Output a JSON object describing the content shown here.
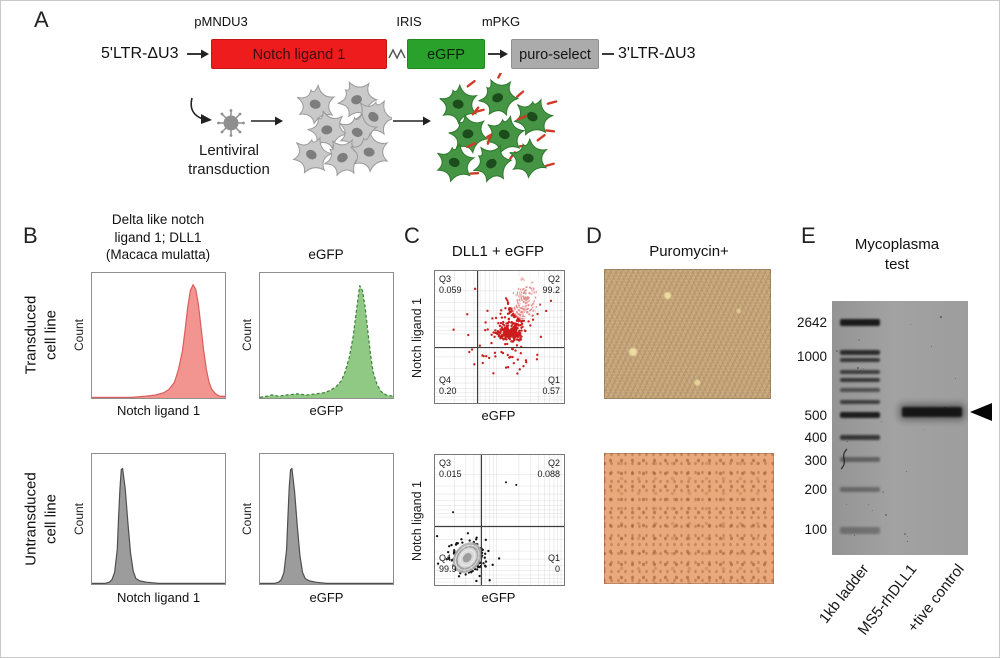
{
  "figure": {
    "panel_a": {
      "letter": "A",
      "construct": {
        "left_ltr": "5'LTR-ΔU3",
        "promoter": "pMNDU3",
        "gene": "Notch ligand 1",
        "linker": "IRIS",
        "reporter": "eGFP",
        "selector_promoter": "mPKG",
        "selector": "puro-select",
        "right_ltr": "3'LTR-ΔU3"
      },
      "transduction_caption": "Lentiviral\ntransduction"
    },
    "panel_b": {
      "letter": "B",
      "col1_title": "Delta like notch\nligand 1; DLL1\n(Macaca mulatta)",
      "col2_title": "eGFP",
      "row1_label": "Transduced\ncell line",
      "row2_label": "Untransduced\ncell line",
      "count_label": "Count",
      "xlabel_dll1": "Notch ligand 1",
      "xlabel_egfp": "eGFP"
    },
    "panel_c": {
      "letter": "C",
      "title": "DLL1 + eGFP",
      "ylabel": "Notch ligand 1",
      "xlabel": "eGFP"
    },
    "panel_d": {
      "letter": "D",
      "title": "Puromycin+"
    },
    "panel_e": {
      "letter": "E",
      "title": "Mycoplasma\ntest"
    }
  },
  "colors": {
    "gene_box": "#ee1c1c",
    "gene_box_border": "#c41414",
    "gene_text": "#3c0d0d",
    "reporter_box": "#2aa12a",
    "reporter_box_border": "#1f8a1f",
    "reporter_text": "#08220a",
    "selector_box": "#ababab",
    "selector_box_border": "#8f8f8f",
    "selector_text": "#151515"
  },
  "chart_data": [
    {
      "id": "hist_transduced_dll1",
      "type": "area",
      "ylabel": "Count",
      "xlabel": "Notch ligand 1",
      "fill": "#f29490",
      "line": "#d95f5c",
      "dashed": false,
      "series": [
        {
          "name": "Transduced cell line",
          "points": [
            [
              0,
              0
            ],
            [
              30,
              0
            ],
            [
              40,
              1
            ],
            [
              48,
              2
            ],
            [
              54,
              4
            ],
            [
              58,
              7
            ],
            [
              62,
              13
            ],
            [
              65,
              24
            ],
            [
              68,
              40
            ],
            [
              70,
              58
            ],
            [
              72,
              78
            ],
            [
              74,
              92
            ],
            [
              76,
              97
            ],
            [
              78,
              93
            ],
            [
              80,
              80
            ],
            [
              82,
              60
            ],
            [
              84,
              40
            ],
            [
              86,
              24
            ],
            [
              88,
              13
            ],
            [
              90,
              7
            ],
            [
              93,
              3
            ],
            [
              96,
              1
            ],
            [
              100,
              1
            ]
          ]
        }
      ]
    },
    {
      "id": "hist_transduced_egfp",
      "type": "area",
      "ylabel": "Count",
      "xlabel": "eGFP",
      "fill": "#8fc984",
      "line": "#3e7d3a",
      "dashed": true,
      "series": [
        {
          "name": "Transduced cell line",
          "points": [
            [
              0,
              0
            ],
            [
              5,
              1
            ],
            [
              9,
              2
            ],
            [
              14,
              1
            ],
            [
              20,
              2
            ],
            [
              28,
              3
            ],
            [
              35,
              2
            ],
            [
              42,
              3
            ],
            [
              48,
              4
            ],
            [
              53,
              6
            ],
            [
              57,
              9
            ],
            [
              61,
              14
            ],
            [
              64,
              22
            ],
            [
              67,
              34
            ],
            [
              70,
              52
            ],
            [
              72,
              70
            ],
            [
              74,
              88
            ],
            [
              75,
              96
            ],
            [
              77,
              92
            ],
            [
              79,
              78
            ],
            [
              81,
              58
            ],
            [
              83,
              38
            ],
            [
              85,
              22
            ],
            [
              88,
              11
            ],
            [
              91,
              5
            ],
            [
              95,
              2
            ],
            [
              100,
              1
            ]
          ]
        }
      ]
    },
    {
      "id": "hist_untransduced_dll1",
      "type": "area",
      "ylabel": "Count",
      "xlabel": "Notch ligand 1",
      "fill": "#9c9c9c",
      "line": "#4f4f4f",
      "dashed": false,
      "series": [
        {
          "name": "Untransduced cell line",
          "points": [
            [
              0,
              0
            ],
            [
              10,
              0
            ],
            [
              13,
              1
            ],
            [
              15,
              3
            ],
            [
              17,
              9
            ],
            [
              19,
              28
            ],
            [
              20,
              55
            ],
            [
              21,
              78
            ],
            [
              22,
              94
            ],
            [
              23,
              95
            ],
            [
              25,
              78
            ],
            [
              27,
              50
            ],
            [
              29,
              25
            ],
            [
              31,
              10
            ],
            [
              33,
              4
            ],
            [
              36,
              2
            ],
            [
              41,
              1
            ],
            [
              50,
              0
            ],
            [
              100,
              0
            ]
          ]
        }
      ]
    },
    {
      "id": "hist_untransduced_egfp",
      "type": "area",
      "ylabel": "Count",
      "xlabel": "eGFP",
      "fill": "#9c9c9c",
      "line": "#4f4f4f",
      "dashed": false,
      "series": [
        {
          "name": "Untransduced cell line",
          "points": [
            [
              0,
              0
            ],
            [
              11,
              0
            ],
            [
              14,
              1
            ],
            [
              16,
              3
            ],
            [
              18,
              9
            ],
            [
              20,
              28
            ],
            [
              21,
              55
            ],
            [
              22,
              80
            ],
            [
              23,
              94
            ],
            [
              24,
              95
            ],
            [
              26,
              76
            ],
            [
              28,
              48
            ],
            [
              30,
              23
            ],
            [
              32,
              9
            ],
            [
              34,
              4
            ],
            [
              37,
              2
            ],
            [
              42,
              1
            ],
            [
              50,
              0
            ],
            [
              100,
              0
            ]
          ]
        }
      ]
    },
    {
      "id": "scatter_transduced",
      "type": "scatter",
      "title": "DLL1 + eGFP",
      "xlabel": "eGFP",
      "ylabel": "Notch ligand 1",
      "dot_color": "#cc1d1d",
      "gate": {
        "x_pct": 33,
        "y_pct": 58
      },
      "quadrants": {
        "q3": {
          "label": "Q3",
          "value": "0.059"
        },
        "q2": {
          "label": "Q2",
          "value": "99.2"
        },
        "q4": {
          "label": "Q4",
          "value": "0.20"
        },
        "q1": {
          "label": "Q1",
          "value": "0.57"
        }
      },
      "clusters": [
        {
          "cx": 58,
          "cy": 47,
          "sx": 5,
          "sy": 3,
          "n": 210
        },
        {
          "cx": 64,
          "cy": 33,
          "sx": 5,
          "sy": 5,
          "n": 110
        },
        {
          "cx": 70,
          "cy": 20,
          "sx": 4.5,
          "sy": 6,
          "n": 90
        },
        {
          "cx": 58,
          "cy": 66,
          "sx": 11,
          "sy": 6,
          "n": 30
        },
        {
          "cx": 50,
          "cy": 45,
          "sx": 16,
          "sy": 14,
          "n": 30
        }
      ],
      "contour": {
        "cx": 71,
        "cy": 18,
        "rot": 12,
        "color": "#ffffff"
      }
    },
    {
      "id": "scatter_untransduced",
      "type": "scatter",
      "title": "",
      "xlabel": "eGFP",
      "ylabel": "Notch ligand 1",
      "dot_color": "#141414",
      "gate": {
        "x_pct": 36,
        "y_pct": 55
      },
      "quadrants": {
        "q3": {
          "label": "Q3",
          "value": "0.015"
        },
        "q2": {
          "label": "Q2",
          "value": "0.088"
        },
        "q4": {
          "label": "Q4",
          "value": "99.9"
        },
        "q1": {
          "label": "Q1",
          "value": "0"
        }
      },
      "clusters": [
        {
          "cx": 25,
          "cy": 80,
          "sx": 5.5,
          "sy": 5,
          "n": 300
        },
        {
          "cx": 25,
          "cy": 79,
          "sx": 10,
          "sy": 9,
          "n": 30
        }
      ],
      "extra_dots": [
        [
          55,
          21
        ],
        [
          63,
          23
        ],
        [
          14,
          44
        ]
      ],
      "contour": {
        "cx": 25,
        "cy": 79,
        "rot": 40,
        "color": "#d9d9d9"
      }
    },
    {
      "id": "gel",
      "type": "table",
      "title": "Mycoplasma test",
      "lanes": [
        "1kb ladder",
        "MS5-rhDLL1",
        "+tive control"
      ],
      "ladder_labels": [
        {
          "text": "2642",
          "y": 322
        },
        {
          "text": "1000",
          "y": 356
        },
        {
          "text": "500",
          "y": 415
        },
        {
          "text": "400",
          "y": 437
        },
        {
          "text": "300",
          "y": 460
        },
        {
          "text": "200",
          "y": 489
        },
        {
          "text": "100",
          "y": 529
        }
      ],
      "ladder_bands": [
        {
          "y": 318,
          "h": 7,
          "o": 0.92
        },
        {
          "y": 349,
          "h": 5,
          "o": 0.8
        },
        {
          "y": 357,
          "h": 4,
          "o": 0.72
        },
        {
          "y": 369,
          "h": 4,
          "o": 0.68
        },
        {
          "y": 377,
          "h": 4,
          "o": 0.72
        },
        {
          "y": 387,
          "h": 4,
          "o": 0.55
        },
        {
          "y": 399,
          "h": 4,
          "o": 0.68
        },
        {
          "y": 411,
          "h": 6,
          "o": 0.9
        },
        {
          "y": 434,
          "h": 5,
          "o": 0.72
        },
        {
          "y": 456,
          "h": 5,
          "o": 0.42
        },
        {
          "y": 486,
          "h": 5,
          "o": 0.36
        },
        {
          "y": 526,
          "h": 7,
          "o": 0.3
        }
      ],
      "sample_band": {
        "lane": "+tive control",
        "y": 406,
        "h": 10
      }
    }
  ]
}
